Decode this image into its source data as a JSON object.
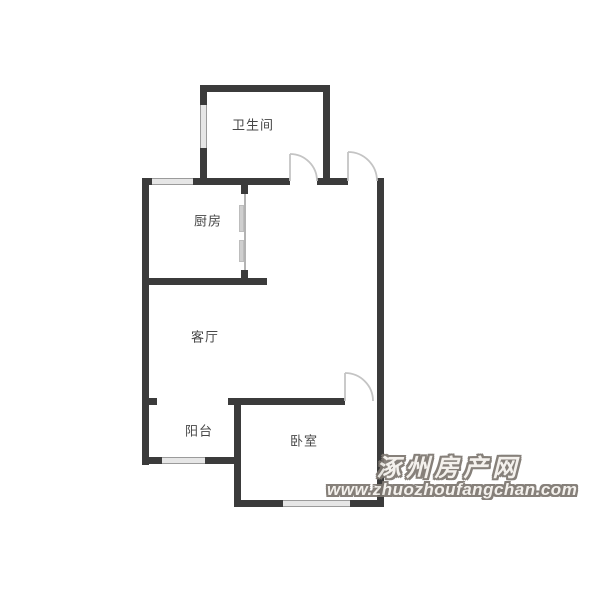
{
  "meta": {
    "type": "floor-plan"
  },
  "palette": {
    "background": "#ffffff",
    "wall": "#3b3b3b",
    "window_fill": "#e6e6e6",
    "window_edge": "#9b9b9b",
    "door_line": "#c4c4c4",
    "slider_panel": "#cfcfcf",
    "label_text": "#474747",
    "watermark_fill": "#f4f1ec",
    "watermark_outline": "#7d7770"
  },
  "rooms": [
    {
      "id": "bathroom",
      "label": "卫生间",
      "cx": 253,
      "cy": 124
    },
    {
      "id": "kitchen",
      "label": "厨房",
      "cx": 208,
      "cy": 220
    },
    {
      "id": "living-room",
      "label": "客厅",
      "cx": 205,
      "cy": 336
    },
    {
      "id": "balcony",
      "label": "阳台",
      "cx": 199,
      "cy": 430
    },
    {
      "id": "bedroom",
      "label": "卧室",
      "cx": 304,
      "cy": 440
    }
  ],
  "floorplan": {
    "walls": [
      {
        "name": "bathroom-top-wall",
        "x": 200,
        "y": 85,
        "w": 130,
        "h": 7
      },
      {
        "name": "bathroom-left-wall",
        "x": 200,
        "y": 85,
        "w": 7,
        "h": 100
      },
      {
        "name": "bathroom-right-wall",
        "x": 323,
        "y": 85,
        "w": 7,
        "h": 100
      },
      {
        "name": "north-wall-left",
        "x": 142,
        "y": 178,
        "w": 148,
        "h": 7
      },
      {
        "name": "north-wall-mid",
        "x": 317,
        "y": 178,
        "w": 31,
        "h": 7
      },
      {
        "name": "left-exterior-wall",
        "x": 142,
        "y": 178,
        "w": 7,
        "h": 287
      },
      {
        "name": "kitchen-door-top-stub",
        "x": 241,
        "y": 185,
        "w": 7,
        "h": 9
      },
      {
        "name": "kitchen-door-bot-stub",
        "x": 241,
        "y": 270,
        "w": 7,
        "h": 15
      },
      {
        "name": "kitchen-bottom-wall",
        "x": 142,
        "y": 278,
        "w": 125,
        "h": 7
      },
      {
        "name": "right-exterior-wall",
        "x": 377,
        "y": 178,
        "w": 7,
        "h": 329
      },
      {
        "name": "balcony-left-stub",
        "x": 142,
        "y": 398,
        "w": 15,
        "h": 7
      },
      {
        "name": "bedroom-top-wall",
        "x": 228,
        "y": 398,
        "w": 117,
        "h": 7
      },
      {
        "name": "balcony-bedroom-divider",
        "x": 234,
        "y": 398,
        "w": 7,
        "h": 109
      },
      {
        "name": "balcony-bottom-wall",
        "x": 142,
        "y": 457,
        "w": 99,
        "h": 7
      },
      {
        "name": "bedroom-bottom-wall",
        "x": 234,
        "y": 500,
        "w": 150,
        "h": 7
      }
    ],
    "windows": [
      {
        "name": "bathroom-window",
        "x": 200,
        "y": 105,
        "w": 7,
        "h": 43,
        "o": "v"
      },
      {
        "name": "kitchen-window",
        "x": 152,
        "y": 178,
        "w": 41,
        "h": 7,
        "o": "h"
      },
      {
        "name": "balcony-window",
        "x": 162,
        "y": 457,
        "w": 43,
        "h": 7,
        "o": "h"
      },
      {
        "name": "bedroom-window",
        "x": 283,
        "y": 500,
        "w": 67,
        "h": 7,
        "o": "h"
      }
    ],
    "slider": {
      "name": "kitchen-sliding-door",
      "line": {
        "x": 244,
        "y1": 194,
        "y2": 270
      },
      "panels": [
        {
          "x": 239,
          "y": 205,
          "w": 5,
          "h": 27
        },
        {
          "x": 239,
          "y": 240,
          "w": 5,
          "h": 22
        }
      ]
    },
    "doors": [
      {
        "name": "bathroom-door",
        "hx": 290,
        "hy": 181,
        "r": 27
      },
      {
        "name": "entry-door",
        "hx": 348,
        "hy": 181,
        "r": 29
      },
      {
        "name": "bedroom-door",
        "hx": 345,
        "hy": 401,
        "r": 28
      }
    ]
  },
  "watermark": {
    "title": "涿州房产网",
    "url": "www.zhuozhoufangchan.com"
  }
}
